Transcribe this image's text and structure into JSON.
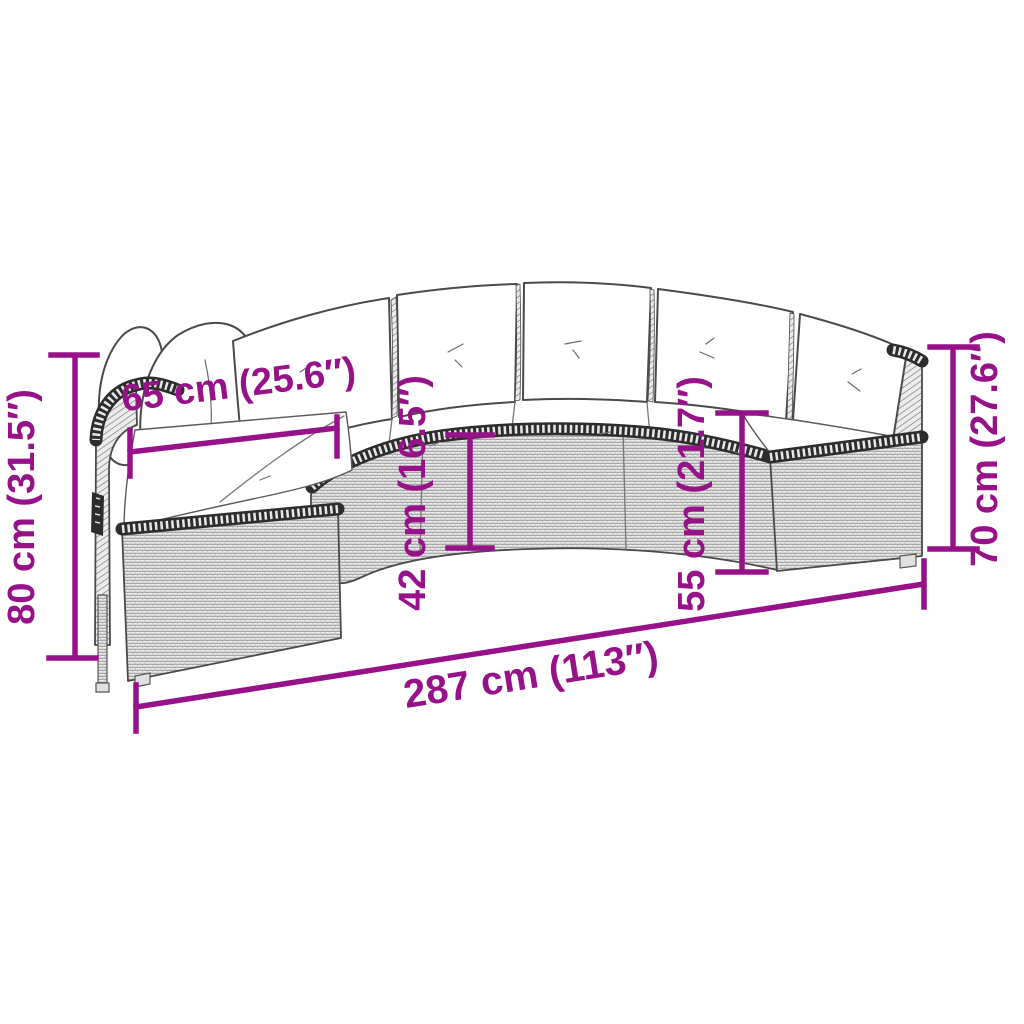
{
  "diagram": {
    "type": "product-dimension-diagram",
    "subject": "half-round poly rattan garden sofa with cushions",
    "colors": {
      "dimension": "#971288",
      "line_art": "#4a4a4a",
      "rattan_fill": "#ededed",
      "cushion_fill": "#ffffff",
      "background": "#ffffff"
    },
    "dimensions": {
      "overall_width": {
        "label": "287 cm (113″)",
        "cm": "287",
        "inches": "113″"
      },
      "overall_height_left": {
        "label": "80 cm (31.5″)",
        "cm": "80",
        "inches": "31.5″"
      },
      "seat_depth": {
        "label": "65 cm (25.6″)",
        "cm": "65",
        "inches": "25.6″"
      },
      "base_front_height": {
        "label": "42 cm (16.5″)",
        "cm": "42",
        "inches": "16.5″"
      },
      "seat_height": {
        "label": "55 cm (21.7″)",
        "cm": "55",
        "inches": "21.7″"
      },
      "back_height_right": {
        "label": "70 cm (27.6″)",
        "cm": "70",
        "inches": "27.6″"
      }
    }
  }
}
